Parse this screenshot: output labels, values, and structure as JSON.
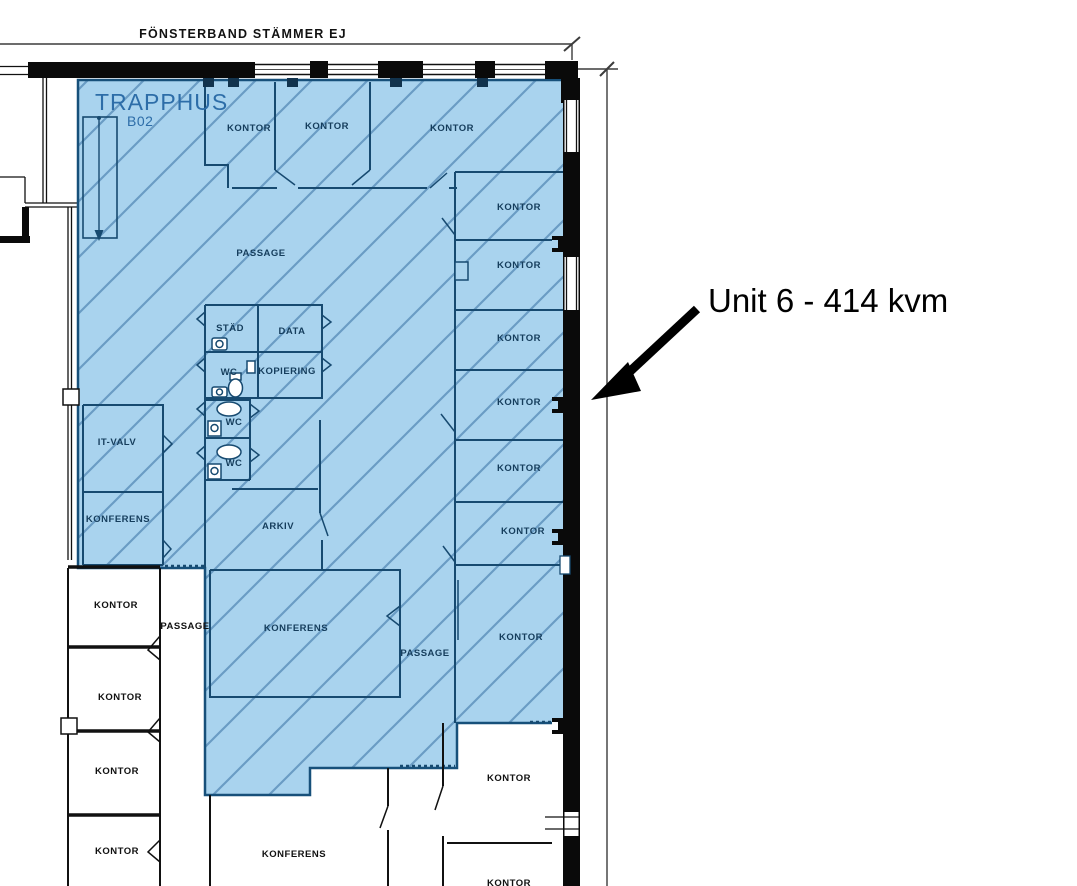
{
  "colors": {
    "unit_fill": "#a9d3ee",
    "hatch_line": "#6a9cc4",
    "wall_navy": "#174a70",
    "wall_black": "#111111",
    "label_navy": "#153d5c",
    "label_black": "#111111",
    "stair_label_blue": "#2d6da8",
    "dimension_gray": "#3c3c3c",
    "callout_black": "#000000"
  },
  "annotations": {
    "top_note": "FÖNSTERBAND STÄMMER EJ",
    "unit_callout": "Unit 6 - 414 kvm"
  },
  "stairwell": {
    "name": "TRAPPHUS",
    "code": "B02"
  },
  "room_labels": [
    {
      "text": "KONTOR"
    },
    {
      "text": "KONTOR"
    },
    {
      "text": "KONTOR"
    },
    {
      "text": "KONTOR"
    },
    {
      "text": "KONTOR"
    },
    {
      "text": "KONTOR"
    },
    {
      "text": "KONTOR"
    },
    {
      "text": "KONTOR"
    },
    {
      "text": "KONTOR"
    },
    {
      "text": "KONTOR"
    },
    {
      "text": "PASSAGE"
    },
    {
      "text": "STÄD"
    },
    {
      "text": "DATA"
    },
    {
      "text": "WC"
    },
    {
      "text": "KOPIERING"
    },
    {
      "text": "WC"
    },
    {
      "text": "WC"
    },
    {
      "text": "IT-VALV"
    },
    {
      "text": "KONFERENS"
    },
    {
      "text": "ARKIV"
    },
    {
      "text": "KONTOR"
    },
    {
      "text": "PASSAGE"
    },
    {
      "text": "KONFERENS"
    },
    {
      "text": "PASSAGE"
    },
    {
      "text": "KONTOR"
    },
    {
      "text": "KONTOR"
    },
    {
      "text": "KONTOR"
    },
    {
      "text": "KONFERENS"
    },
    {
      "text": "KONTOR"
    },
    {
      "text": "KONTOR"
    }
  ]
}
